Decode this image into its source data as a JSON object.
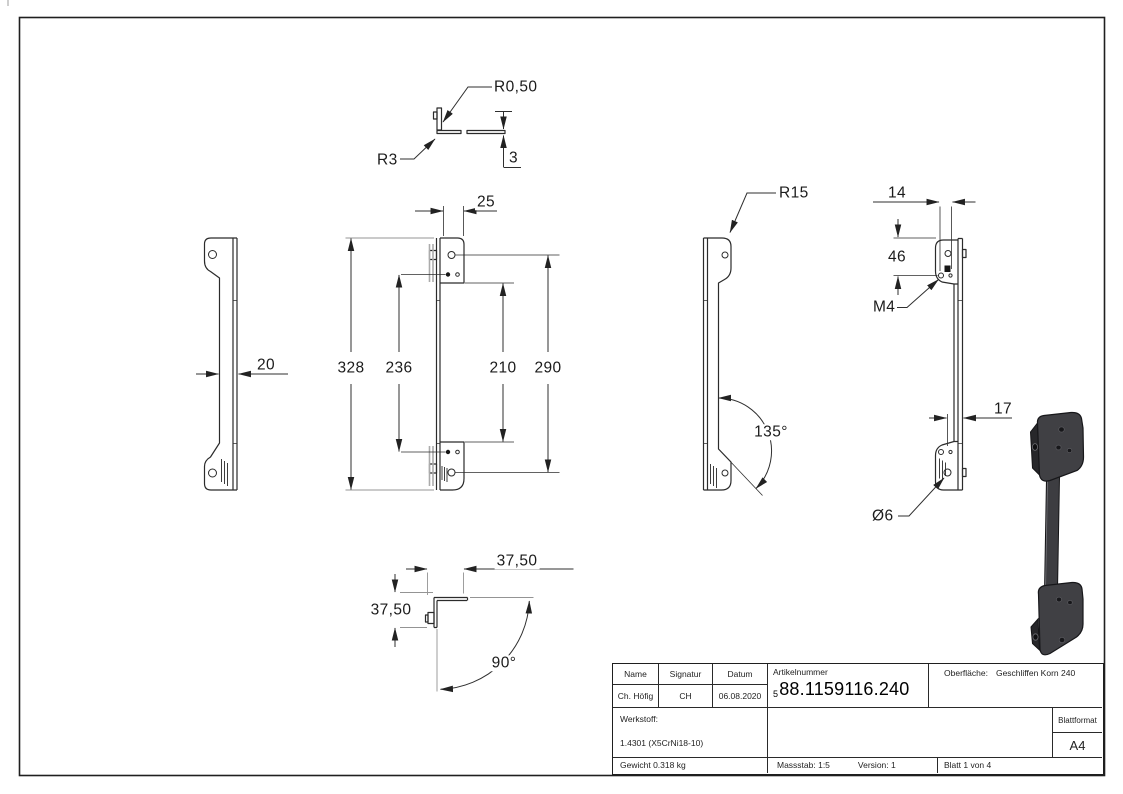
{
  "dimensions": {
    "r0_50": "R0,50",
    "r3": "R3",
    "t3": "3",
    "t20": "20",
    "t25": "25",
    "t328": "328",
    "t236": "236",
    "t210": "210",
    "t290": "290",
    "r15": "R15",
    "a135": "135°",
    "t14": "14",
    "t46": "46",
    "m4": "M4",
    "t17": "17",
    "dia6": "Ø6",
    "t37_top": "37,50",
    "t37_left": "37,50",
    "a90": "90°"
  },
  "title_block": {
    "name_label": "Name",
    "signatur_label": "Signatur",
    "datum_label": "Datum",
    "name": "Ch. Höfig",
    "signatur": "CH",
    "datum": "06.08.2020",
    "artikelnummer_label": "Artikelnummer",
    "artikelnummer_prefix": "5",
    "artikelnummer": "88.1159116.240",
    "oberflaeche_label": "Oberfläche:",
    "oberflaeche": "Geschliffen Korn 240",
    "werkstoff_label": "Werkstoff:",
    "werkstoff": "1.4301 (X5CrNi18-10)",
    "gewicht": "Gewicht 0.318 kg",
    "massstab": "Massstab: 1:5",
    "version": "Version: 1",
    "blatt": "Blatt 1 von 4",
    "blattformat_label": "Blattformat",
    "blattformat": "A4"
  }
}
